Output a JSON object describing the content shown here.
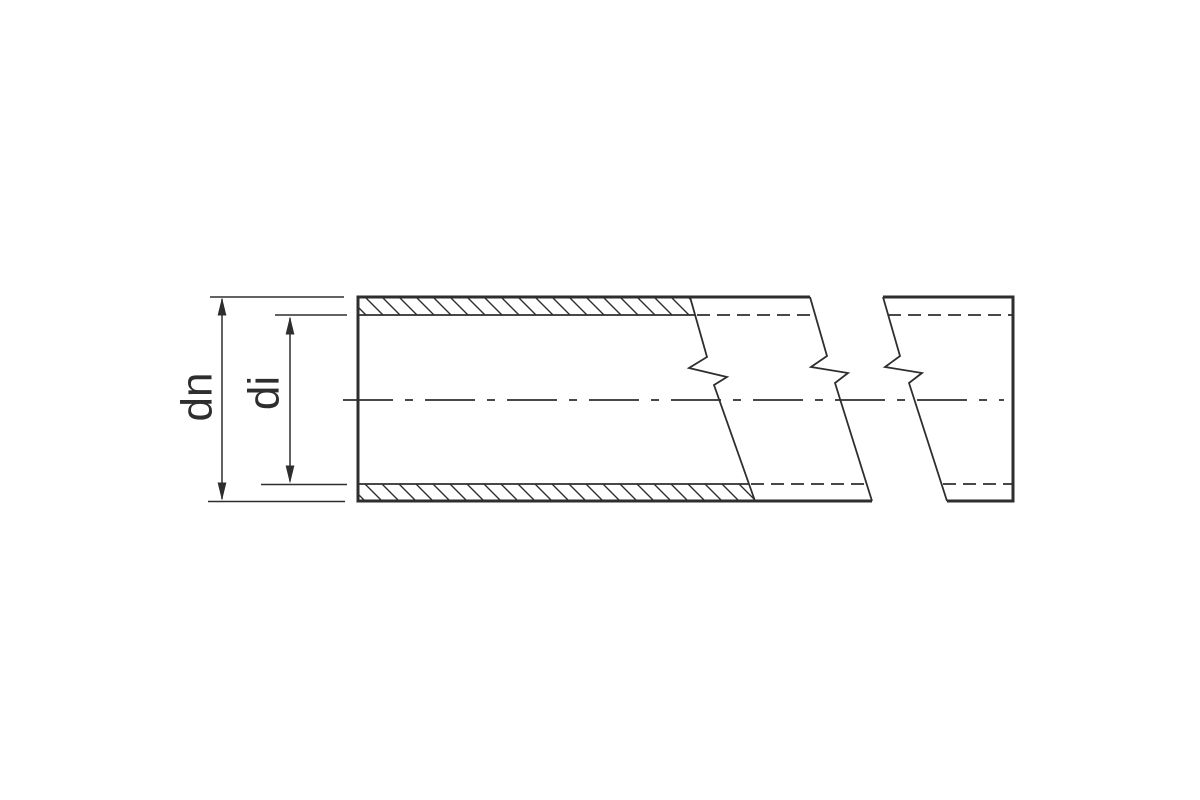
{
  "diagram": {
    "labels": {
      "outer_diameter": "dn",
      "inner_diameter": "di"
    },
    "colors": {
      "line": "#2e2e2e",
      "background": "#ffffff"
    }
  }
}
